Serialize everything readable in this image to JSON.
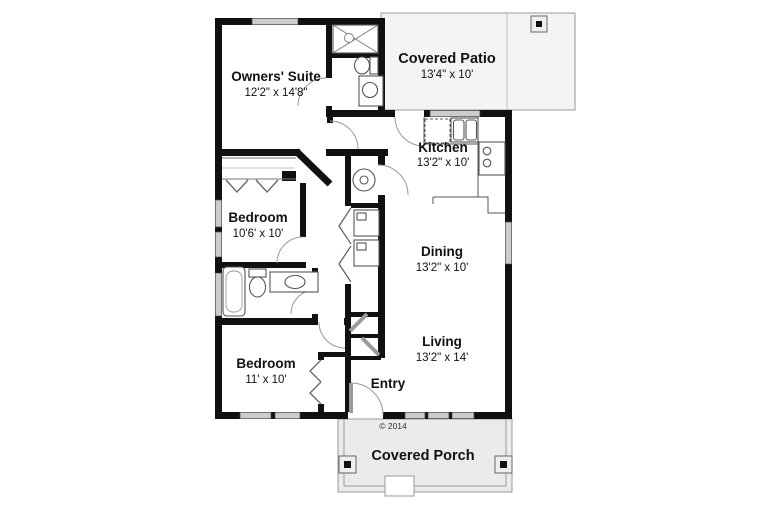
{
  "title": "House floor plan",
  "rooms": {
    "owners_suite": {
      "name": "Owners' Suite",
      "dims": "12'2\" x 14'8\""
    },
    "covered_patio": {
      "name": "Covered Patio",
      "dims": "13'4\" x 10'"
    },
    "kitchen": {
      "name": "Kitchen",
      "dims": "13'2\" x 10'"
    },
    "bedroom_upper": {
      "name": "Bedroom",
      "dims": "10'6' x 10'"
    },
    "dining": {
      "name": "Dining",
      "dims": "13'2\" x 10'"
    },
    "bedroom_lower": {
      "name": "Bedroom",
      "dims": "11' x 10'"
    },
    "living": {
      "name": "Living",
      "dims": "13'2\" x 14'"
    },
    "entry": {
      "name": "Entry"
    },
    "covered_porch": {
      "name": "Covered Porch"
    }
  },
  "annotations": {
    "copyright": "© 2014"
  },
  "colors": {
    "wall": "#111111",
    "window": "#cccccc",
    "patio_fill": "#f4f4f4",
    "porch_fill": "#ebebeb",
    "fixture_stroke": "#555555",
    "door_arc": "#999999",
    "text": "#111111"
  },
  "icons": [
    "shower-icon",
    "toilet-icon",
    "vanity-sink-icon",
    "bathtub-icon",
    "kitchen-sink-icon",
    "range-icon",
    "dishwasher-icon",
    "washer-icon",
    "dryer-icon",
    "water-heater-icon",
    "porch-post-icon",
    "bifold-door-icon",
    "door-swing-icon",
    "step-icon"
  ]
}
